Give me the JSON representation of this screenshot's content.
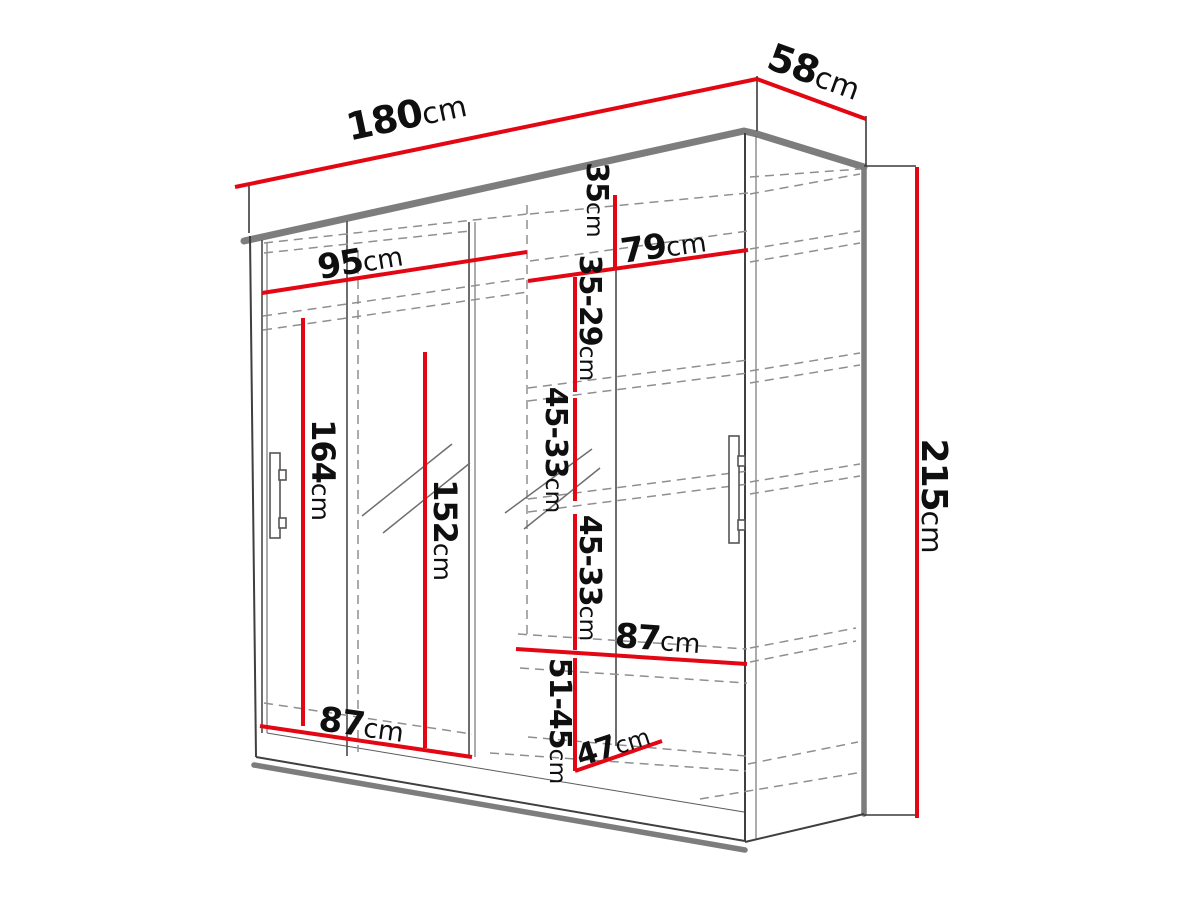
{
  "diagram": {
    "type": "furniture-dimension-diagram",
    "subject": "sliding-door wardrobe with mirror",
    "unit": "cm",
    "colors": {
      "dimension_line": "#e30613",
      "outline_gray": "#7d7d7d",
      "thin_line": "#3f3f3f",
      "hidden_edge_dashed": "#8f8f8f",
      "label_text": "#0f0f0f",
      "background": "#ffffff"
    },
    "dimensions": {
      "total_width": {
        "num": "180",
        "unit": "cm"
      },
      "total_depth": {
        "num": "58",
        "unit": "cm"
      },
      "total_height": {
        "num": "215",
        "unit": "cm"
      },
      "left_section_width": {
        "num": "95",
        "unit": "cm"
      },
      "right_section_width": {
        "num": "79",
        "unit": "cm"
      },
      "top_right_shelf_height": {
        "num": "35",
        "unit": "cm"
      },
      "upper_shelf_spacing": {
        "num": "35-29",
        "unit": "cm"
      },
      "middle_shelf_spacing_1": {
        "num": "45-33",
        "unit": "cm"
      },
      "middle_shelf_spacing_2": {
        "num": "45-33",
        "unit": "cm"
      },
      "lower_shelf_spacing": {
        "num": "51-45",
        "unit": "cm"
      },
      "left_interior_height": {
        "num": "164",
        "unit": "cm"
      },
      "mirror_height": {
        "num": "152",
        "unit": "cm"
      },
      "right_shelf_width": {
        "num": "87",
        "unit": "cm"
      },
      "bottom_left_width": {
        "num": "87",
        "unit": "cm"
      },
      "bottom_shelf_depth": {
        "num": "47",
        "unit": "cm"
      }
    }
  }
}
